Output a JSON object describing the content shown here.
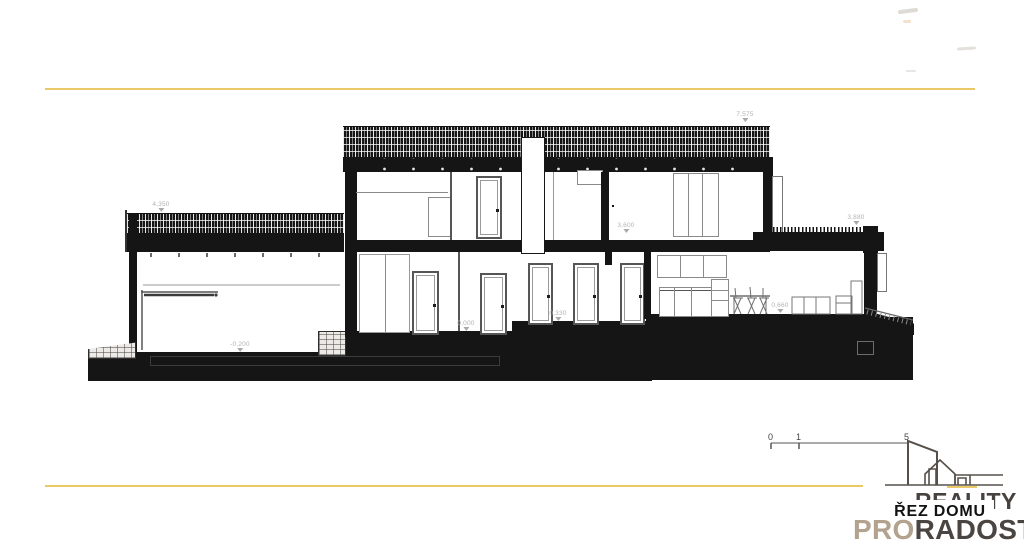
{
  "drawing": {
    "title": "ŘEZ DOMU",
    "elevation_labels": [
      {
        "name": "garage-roof",
        "text": "4,350"
      },
      {
        "name": "main-roof",
        "text": "7,575"
      },
      {
        "name": "upper-floor",
        "text": "3,600"
      },
      {
        "name": "low-roof",
        "text": "3,880"
      },
      {
        "name": "ground-floor",
        "text": "0,000"
      },
      {
        "name": "hall-step",
        "text": "0,330"
      },
      {
        "name": "living-floor",
        "text": "0,660"
      },
      {
        "name": "garage-floor",
        "text": "-0,200"
      }
    ]
  },
  "scale_bar": {
    "ticks": [
      "0",
      "1",
      "5"
    ]
  },
  "branding": {
    "word_back": "REALITY",
    "overlay_label": "ŘEZ DOMU",
    "word_pro": "PRO",
    "word_radost": "RADOST",
    "colors": {
      "accent_yellow": "#ecc968",
      "brand_dark": "#47423f",
      "brand_tan": "#b3a28d"
    }
  }
}
